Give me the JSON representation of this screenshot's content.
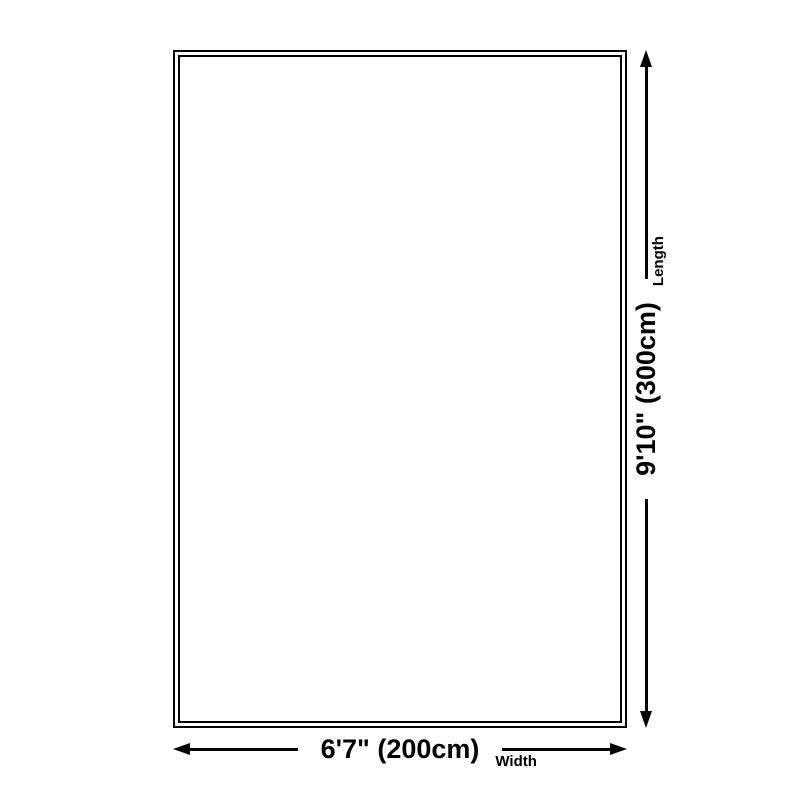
{
  "page": {
    "background_color": "#ffffff",
    "line_color": "#000000"
  },
  "diagram": {
    "type": "product-size-dimension-diagram",
    "rect": {
      "border_style": "double",
      "border_color": "#000000"
    },
    "width_dim": {
      "value": "6'7\" (200cm)",
      "caption": "Width"
    },
    "length_dim": {
      "value": "9'10\" (300cm)",
      "caption": "Length"
    },
    "icons": {
      "left_arrowhead": "left-arrowhead-icon",
      "right_arrowhead": "right-arrowhead-icon",
      "up_arrowhead": "up-arrowhead-icon",
      "down_arrowhead": "down-arrowhead-icon"
    }
  }
}
